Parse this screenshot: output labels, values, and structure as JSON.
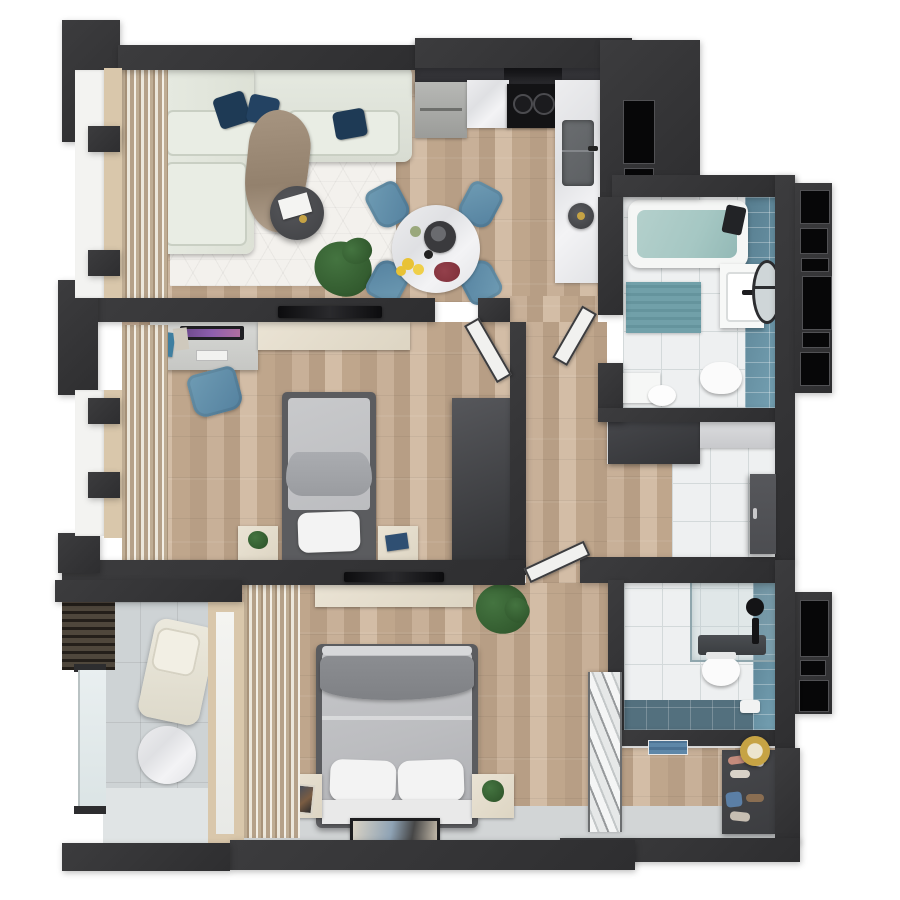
{
  "meta": {
    "title": "3D apartment floor plan - top-down render",
    "view": "top-down photorealistic render on white background",
    "visible_text": "none"
  },
  "palette": {
    "white": "#ffffff",
    "wall": "#3c3c3e",
    "wallEdge": "#2e2e30",
    "black": "#070708",
    "ledge": "#f3f3f1",
    "frameBeige": "#d9c7ab",
    "woodA": "#c8b098",
    "woodB": "#b79e85",
    "woodC": "#d3bda6",
    "woodD": "#bfa68c",
    "grout": "#d3d9da",
    "tileFloor": "#eef0f1",
    "teal": "#567c8e",
    "tealLight": "#74a0b2",
    "tealDeep": "#53707e",
    "water": "#a5c7c3",
    "matTeal": "#71a0a9",
    "rug": "#f3f1ed",
    "sofa": "#e6eae1",
    "sofaEdge": "#c9cfc3",
    "navy": "#1e3a55",
    "throw": "#a79581",
    "tableDark": "#404144",
    "plantGreen": "#447440",
    "plantDark": "#2c5128",
    "marble": "#e9e9eb",
    "cabinetDark": "#2a2a2e",
    "hood": "#18181b",
    "steel": "#b7b8b5",
    "cooktop": "#131315",
    "sinkGray": "#5d6063",
    "chairBlue": "#6f9cb4",
    "chairBlueDark": "#54819f",
    "cream": "#eae3d4",
    "desk": "#d7d8d5",
    "monitor": "#1f1f23",
    "screenGlow": "#8e5fae",
    "bedFrame": "#5b5c5f",
    "duvet": "#bcbdc0",
    "duvetDark": "#7f8185",
    "pillow": "#f3f3f3",
    "platform": "#e9e9e9",
    "curtain": "#bfad94",
    "curtainLight": "#ece7db",
    "concrete": "#ced3d5",
    "concreteLight": "#e0e4e5",
    "slatDark": "#4f473c",
    "glass": "#e9eff0",
    "gold": "#c6a344",
    "doorDark": "#4c4d51",
    "doorWhite": "#f1f1ef",
    "grayStrip": "#d2d5d6",
    "shelfDark": "#3c3d40",
    "lemon": "#e8c235",
    "flowerRed": "#7e2f39",
    "towelBlue": "#5e87a8"
  },
  "rooms": [
    {
      "id": "living-room",
      "label": "Living room",
      "furniture": [
        "L-shaped cream sofa",
        "3 navy throw pillows",
        "tan throw blanket",
        "white geometric rug",
        "round dark coffee table with magazine",
        "potted plant",
        "floor-to-ceiling beige curtains",
        "left window wall"
      ]
    },
    {
      "id": "kitchen",
      "label": "Kitchen",
      "furniture": [
        "dark upper cabinet run",
        "range hood",
        "black 2-burner cooktop",
        "marble countertops",
        "undermount sink with faucet",
        "kettle",
        "round marble dining table",
        "4 steel-blue dining chairs",
        "bowl of lemons",
        "dark red flowers",
        "coffee tray"
      ]
    },
    {
      "id": "bathroom-main",
      "label": "Bathroom 1 (top right)",
      "furniture": [
        "bathtub with water",
        "teal tiled accent wall",
        "white vanity with basin",
        "round black-rim mirror",
        "wall-hung toilet",
        "toilet with cistern",
        "teal bath mat",
        "white tile floor",
        "black exterior window panes"
      ]
    },
    {
      "id": "bedroom",
      "label": "Bedroom (middle left)",
      "furniture": [
        "desk with monitor, keyboard and books",
        "blue desk chair",
        "cream TV sideboard",
        "wall-mounted TV",
        "single bed with gray bedding and white pillow",
        "2 nightstands with plant and book",
        "tall dark wardrobe",
        "curtained window"
      ]
    },
    {
      "id": "hallway",
      "label": "Hallway",
      "furniture": [
        "open white interior doors to bedroom, bathroom and master bedroom"
      ]
    },
    {
      "id": "entry-hall",
      "label": "Entry hall",
      "furniture": [
        "dark console cabinet",
        "light cabinet",
        "white tile floor",
        "dark entrance door on right wall"
      ]
    },
    {
      "id": "bathroom-second",
      "label": "Bathroom 2 (bottom right)",
      "furniture": [
        "glass shower enclosure with dark tray",
        "black shower fixtures",
        "toilet",
        "teal tile floor band",
        "teal tiled wall",
        "black exterior window panes"
      ]
    },
    {
      "id": "entry-corridor",
      "label": "Entry corridor (bottom right)",
      "furniture": [
        "white zigzag folding partition",
        "dark shoe shelf with shoes and bag",
        "round gold-framed mirror",
        "blue towels on shelf"
      ]
    },
    {
      "id": "master-bedroom",
      "label": "Master bedroom",
      "furniture": [
        "double bed with gray duvet and dark throw",
        "2 white pillows",
        "white bench platform",
        "2 cream nightstands with framed picture and plant",
        "long cream dresser",
        "wall-mounted TV",
        "dark-framed accent rug",
        "potted plant",
        "beige curtains"
      ]
    },
    {
      "id": "balcony",
      "label": "Balcony (bottom left)",
      "furniture": [
        "glass railing with dark frame",
        "dark wood-slat screen",
        "cream lounge chair",
        "round marble side table",
        "concrete tile floor",
        "glazed balcony door"
      ]
    }
  ],
  "windows": {
    "left_wall": "two tall windows with beige frames, white exterior ledge and dark mullions",
    "right_wall": "black glazed panes beside both bathrooms"
  }
}
